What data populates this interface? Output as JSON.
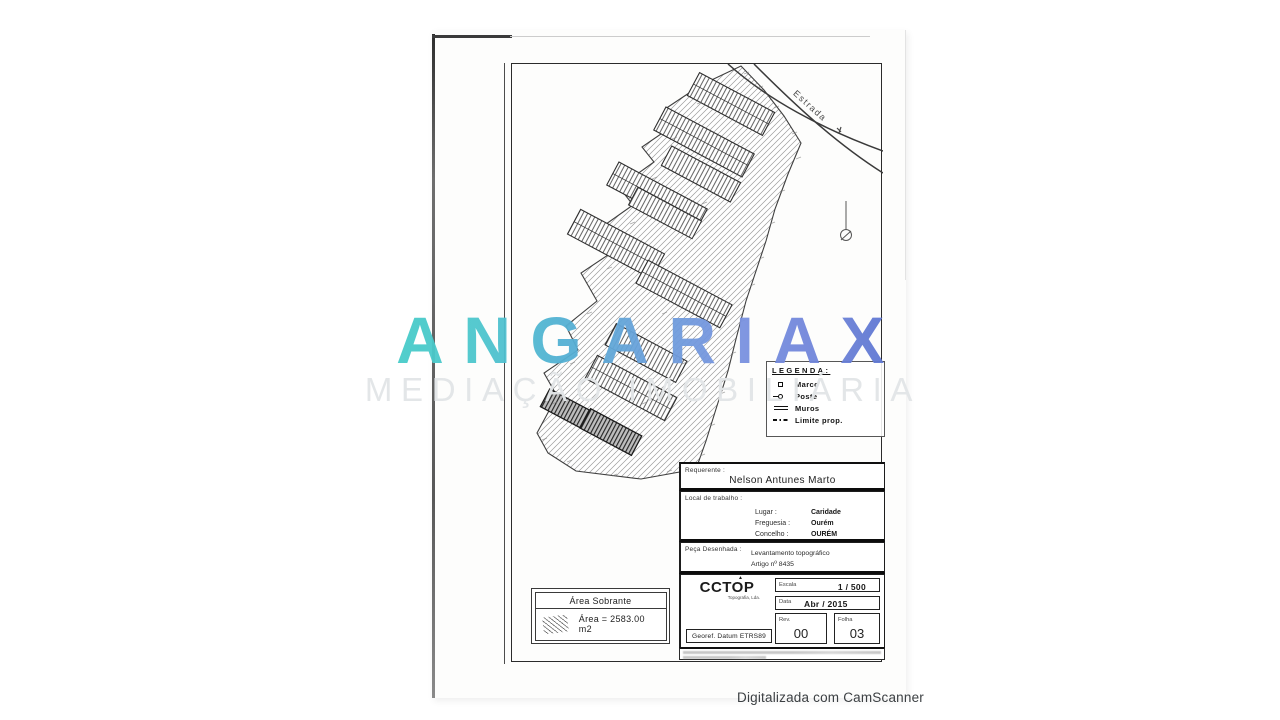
{
  "watermark": {
    "brand": "ANGARIAX",
    "subtitle": "MEDIAÇÃO IMOBILIÁRIA",
    "brand_gradient_start": "#47CCC9",
    "brand_gradient_end": "#5B74D0",
    "subtitle_color": "#E2E5E7"
  },
  "footer": {
    "scanner_note": "Digitalizada com CamScanner"
  },
  "plan": {
    "road_label": "Estrada",
    "legend": {
      "title": "LEGENDA:",
      "items": [
        {
          "icon": "marco-symbol",
          "label": "Marco"
        },
        {
          "icon": "poste-symbol",
          "label": "Poste"
        },
        {
          "icon": "muros-symbol",
          "label": "Muros"
        },
        {
          "icon": "limite-prop-symbol",
          "label": "Limite prop."
        }
      ]
    },
    "area_box": {
      "title": "Área Sobrante",
      "value": "Área = 2583.00 m2"
    }
  },
  "title_block": {
    "requerente": {
      "label": "Requerente :",
      "value": "Nelson Antunes Marto"
    },
    "local": {
      "label": "Local de trabalho :",
      "rows": [
        {
          "label": "Lugar :",
          "value": "Caridade"
        },
        {
          "label": "Freguesia :",
          "value": "Ourém"
        },
        {
          "label": "Concelho :",
          "value": "OURÉM"
        }
      ]
    },
    "peca": {
      "label": "Peça Desenhada :",
      "line1": "Levantamento topográfico",
      "line2": "Artigo nº 8435"
    },
    "logo": {
      "name": "CCTOP",
      "subtext": "Topografia, Lda."
    },
    "georef": "Georef. Datum ETRS89",
    "escala": {
      "label": "Escala",
      "value": "1 / 500"
    },
    "data": {
      "label": "Data",
      "value": "Abr / 2015"
    },
    "rev": {
      "label": "Rev.",
      "value": "00"
    },
    "folha": {
      "label": "Folha",
      "value": "03"
    }
  }
}
